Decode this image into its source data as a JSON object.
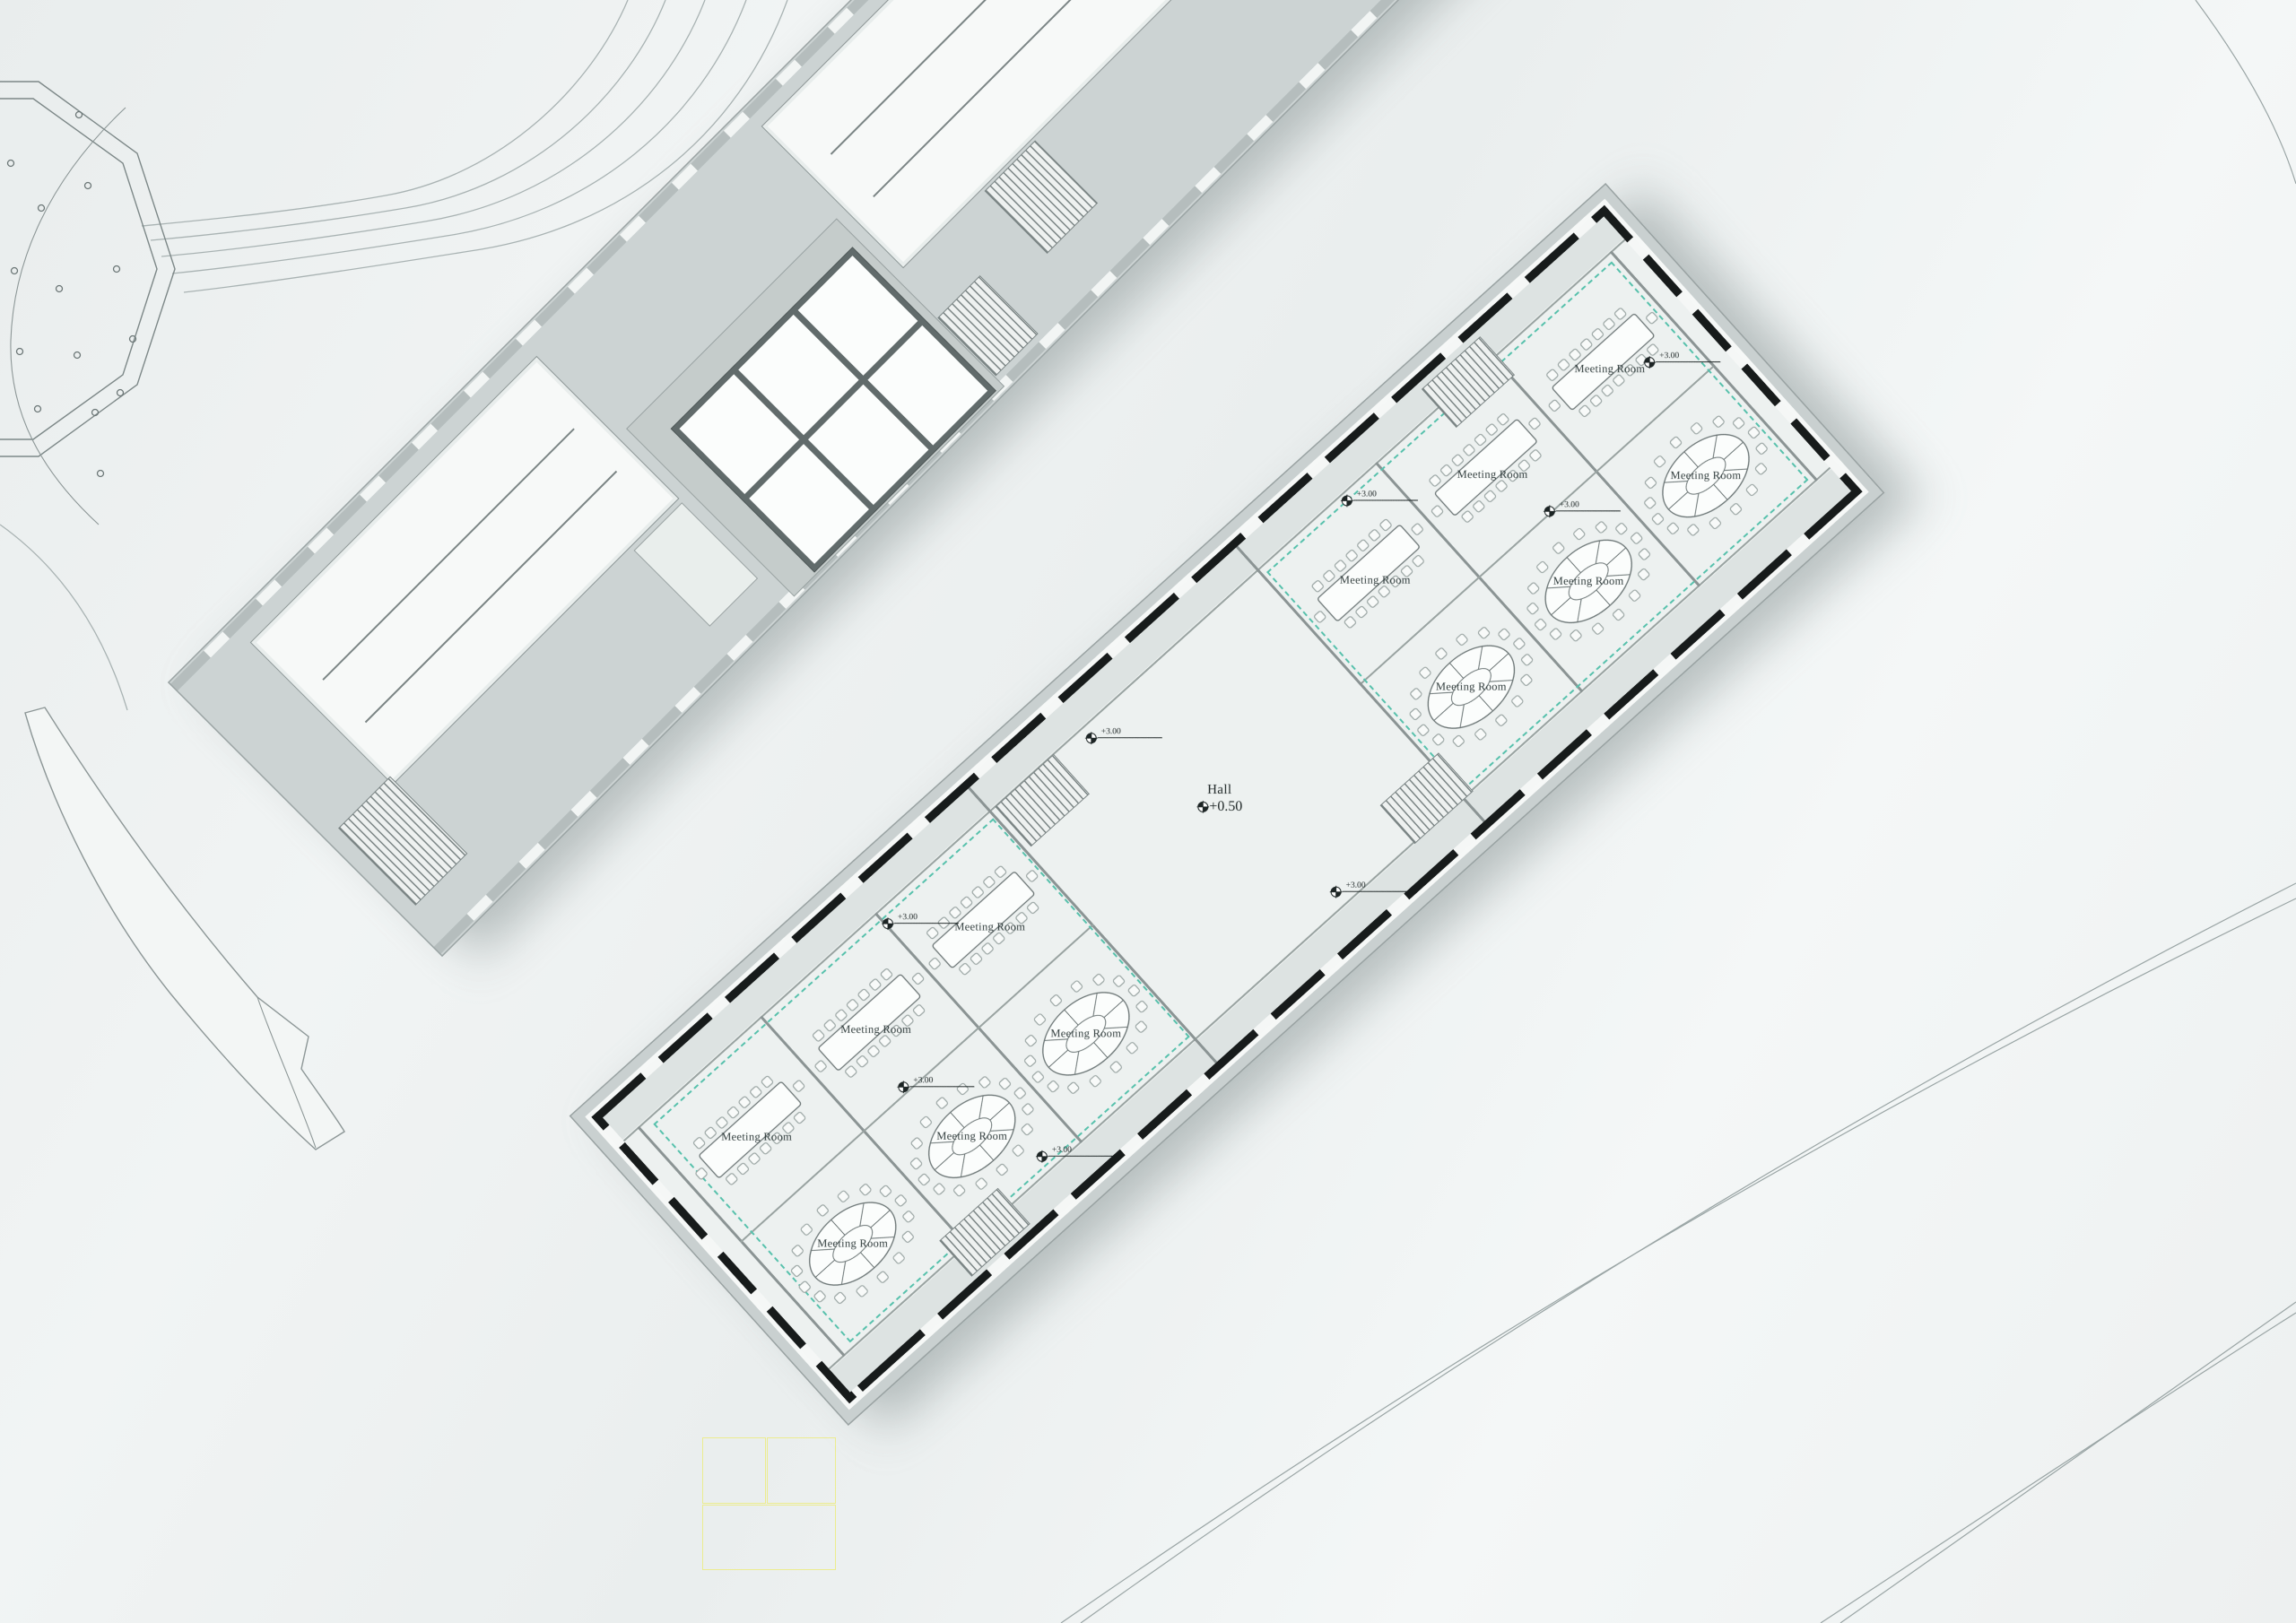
{
  "page": {
    "background": "#eef1f1"
  },
  "site": {
    "contour_color": "#a9b3b3",
    "plaza_outline_color": "#7d8888",
    "walkway_fill": "#f3f6f5",
    "survey_grid_color": "#ecec8f"
  },
  "annex_building": {
    "skylights": {
      "rows": 2,
      "cols": 3
    },
    "roof_color": "#ccd3d3",
    "slab_color": "#f7f9f8"
  },
  "main_building": {
    "wall_color": "#171b1b",
    "floor_color": "#edf1f0",
    "corridor_color": "#dde3e2",
    "terrace_color": "#c9d0d0",
    "glass_partition_color": "#57c1ac",
    "hall": {
      "label": "Hall",
      "elevation": "+0.50"
    },
    "rooms": [
      {
        "label": "Meeting Room",
        "table": "rectangular"
      },
      {
        "label": "Meeting Room",
        "table": "rectangular"
      },
      {
        "label": "Meeting Room",
        "table": "rectangular"
      },
      {
        "label": "Meeting Room",
        "table": "oval"
      },
      {
        "label": "Meeting Room",
        "table": "oval"
      },
      {
        "label": "Meeting Room",
        "table": "oval"
      },
      {
        "label": "Meeting Room",
        "table": "rectangular"
      },
      {
        "label": "Meeting Room",
        "table": "rectangular"
      },
      {
        "label": "Meeting Room",
        "table": "rectangular"
      },
      {
        "label": "Meeting Room",
        "table": "oval"
      },
      {
        "label": "Meeting Room",
        "table": "oval"
      },
      {
        "label": "Meeting Room",
        "table": "oval"
      }
    ],
    "elevation_markers": [
      {
        "value": "+3.00"
      },
      {
        "value": "+3.00"
      },
      {
        "value": "+3.00"
      },
      {
        "value": "+3.00"
      },
      {
        "value": "+3.00"
      },
      {
        "value": "+3.00"
      },
      {
        "value": "+3.00"
      },
      {
        "value": "+3.00"
      }
    ]
  }
}
